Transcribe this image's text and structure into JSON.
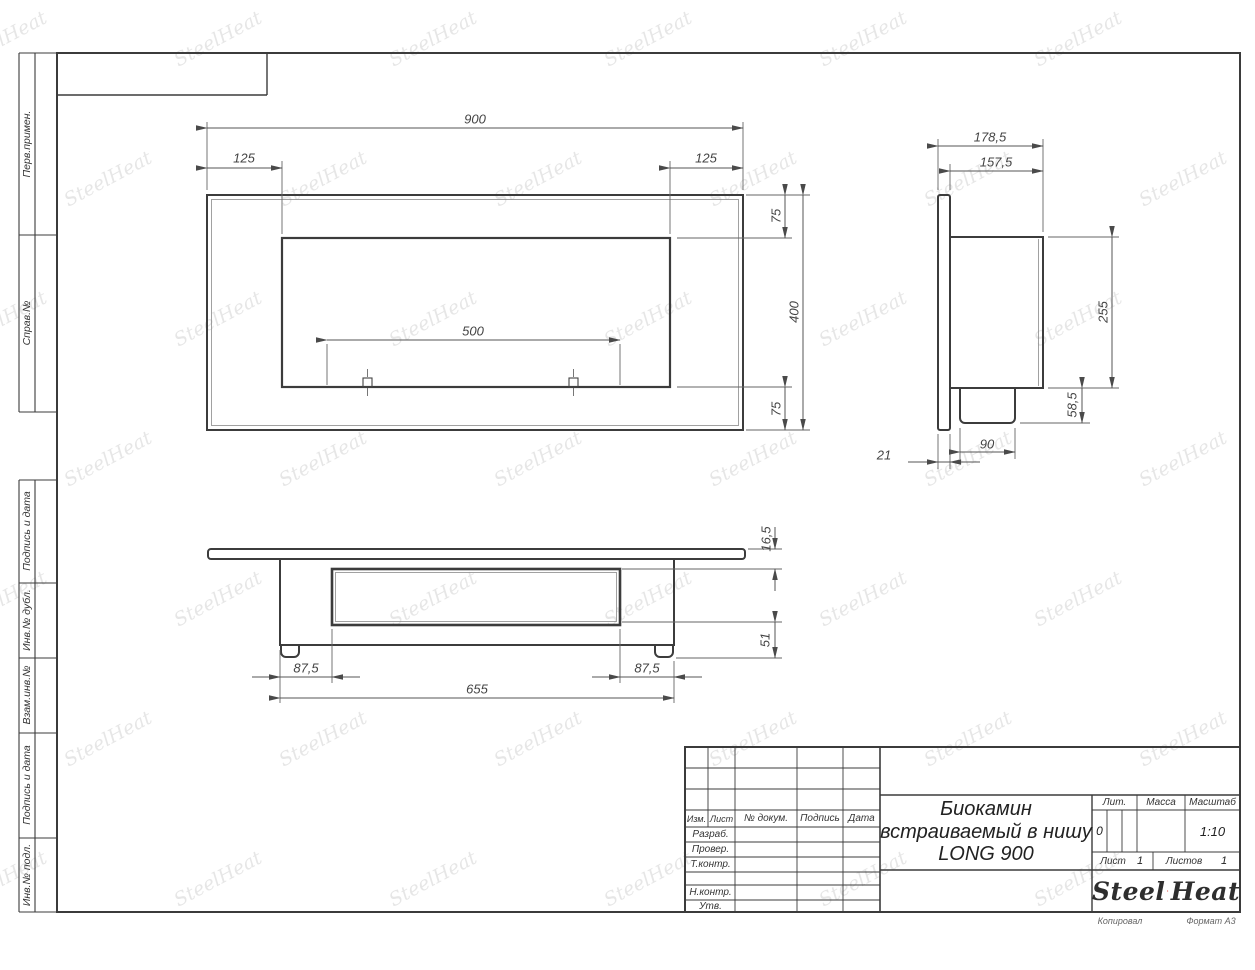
{
  "doc": {
    "title_lines": [
      "Биокамин",
      "встраиваемый в нишу",
      "LONG 900"
    ],
    "copied_label": "Копировал",
    "format_label": "Формат A3"
  },
  "stamp": {
    "cols": {
      "izm": "Изм.",
      "list": "Лист",
      "doc_num": "№ докум.",
      "sign": "Подпись",
      "date": "Дата"
    },
    "rows": {
      "razrab": "Разраб.",
      "prover": "Провер.",
      "tkontr": "Т.контр.",
      "nkontr": "Н.контр.",
      "utv": "Утв."
    },
    "lit_label": "Лит.",
    "lit_value": "0",
    "mass_label": "Масса",
    "scale_label": "Масштаб",
    "scale_value": "1:10",
    "sheet_label": "Лист",
    "sheet_value": "1",
    "sheets_label": "Листов",
    "sheets_value": "1"
  },
  "logo": {
    "steel": "Steel",
    "heat": "Heat",
    "flame_color": "#d9261c"
  },
  "margin_labels": [
    {
      "text": "Перв.примен."
    },
    {
      "text": "Справ.№"
    },
    {
      "text": "Подпись и дата"
    },
    {
      "text": "Инв.№ дубл."
    },
    {
      "text": "Взам.инв.№"
    },
    {
      "text": "Подпись и дата"
    },
    {
      "text": "Инв.№ подл."
    }
  ],
  "dims": {
    "front": {
      "width": "900",
      "left_inset": "125",
      "right_inset": "125",
      "top_inset": "75",
      "height": "400",
      "bottom_inset": "75",
      "opening": "500"
    },
    "side": {
      "depth_total": "178,5",
      "depth_body": "157,5",
      "body_height": "255",
      "box_height": "58,5",
      "box_depth": "90",
      "panel_thickness": "21"
    },
    "bottom": {
      "lip": "16,5",
      "inset_depth": "51",
      "left_margin": "87,5",
      "right_margin": "87,5",
      "body_width": "655"
    }
  },
  "watermark": {
    "text": "SteelHeat"
  }
}
